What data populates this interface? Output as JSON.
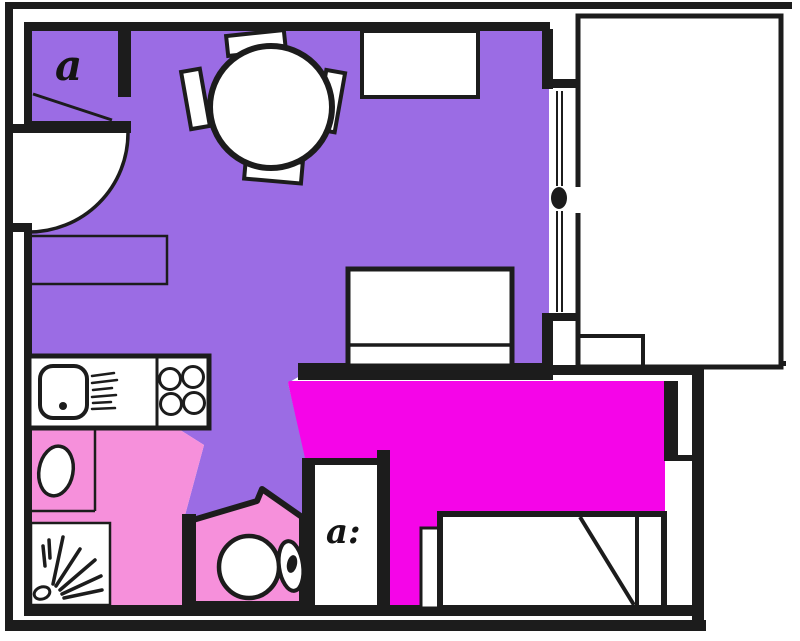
{
  "plan": {
    "labels": {
      "hall": "a",
      "wc_door": "a:"
    },
    "colors": {
      "living_area": "#9B6CE4",
      "bathroom": "#F690DB",
      "bedroom": "#F505E8",
      "walls": "#1C1C1C",
      "background": "#FFFFFF"
    },
    "elements": [
      "entrance-door-swing",
      "hall-closet",
      "dining-table",
      "dining-chairs",
      "window-sideboard",
      "wall-shelf",
      "kitchen-counter",
      "kitchen-sink",
      "hob-burners",
      "drainboard",
      "sofa",
      "balcony",
      "balcony-door",
      "washbasin",
      "shower",
      "toilet",
      "wc-room",
      "bedroom",
      "bed",
      "nightstand"
    ]
  }
}
